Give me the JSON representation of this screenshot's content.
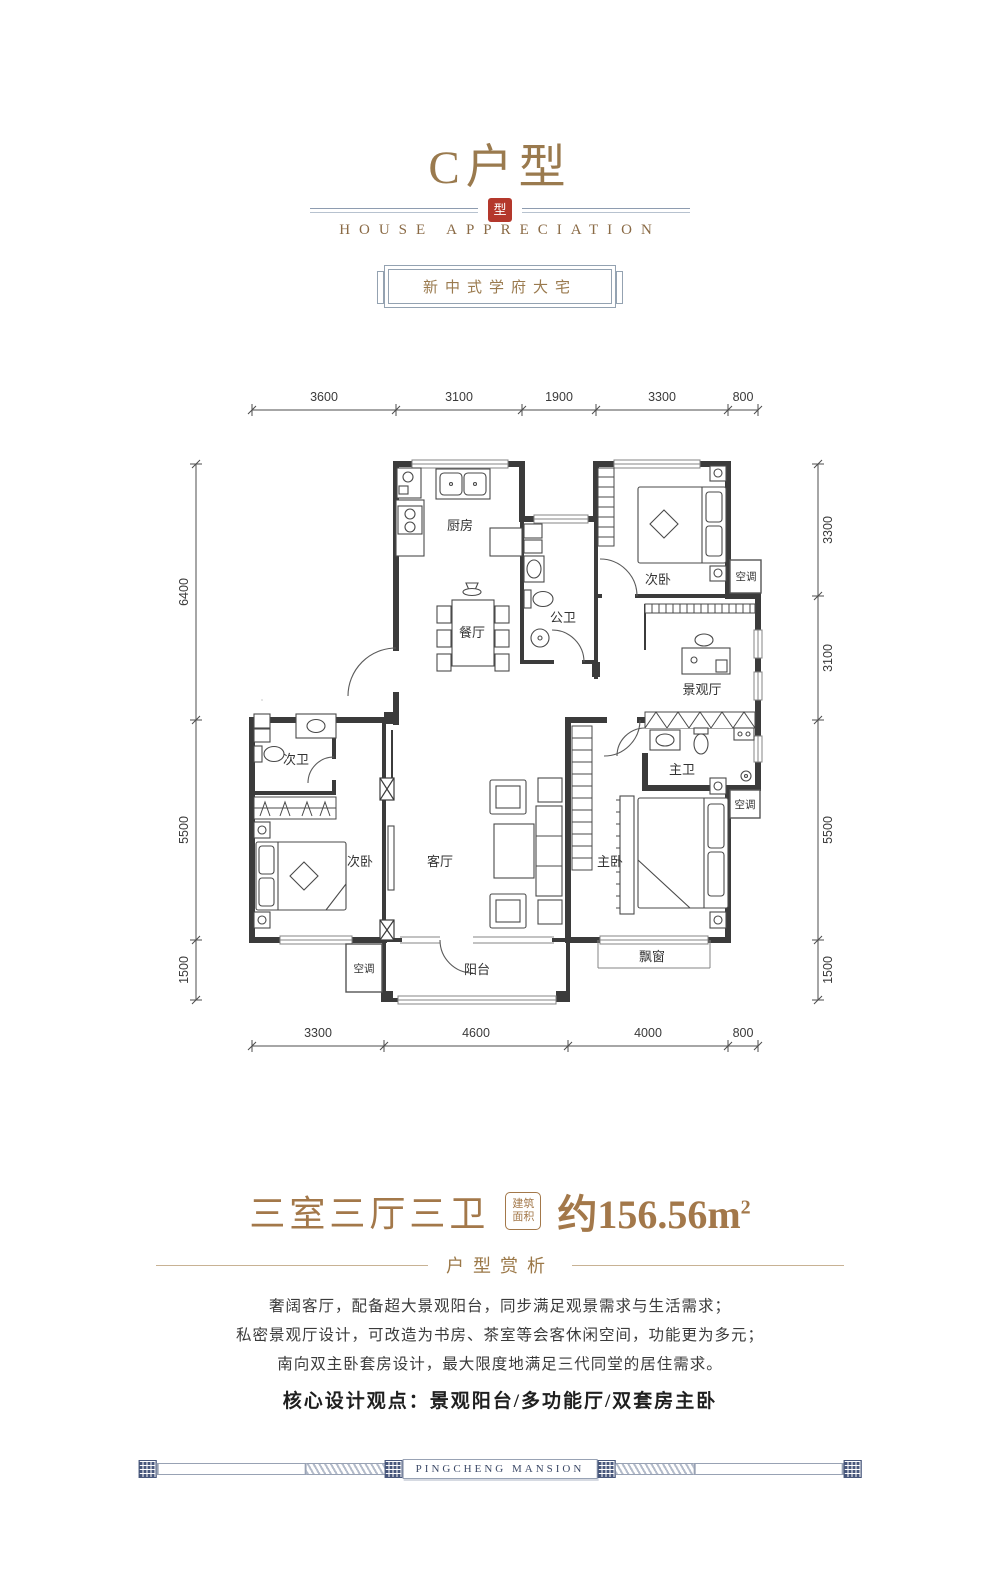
{
  "header": {
    "title": "C户型",
    "seal_glyph": "型",
    "subtitle": "HOUSE APPRECIATION",
    "badge": "新中式学府大宅"
  },
  "plan": {
    "rooms": {
      "kitchen": "厨房",
      "dining": "餐厅",
      "public_bath": "公卫",
      "bedroom2": "次卧",
      "view_hall": "景观厅",
      "master_bath": "主卫",
      "bath2": "次卫",
      "living": "客厅",
      "master": "主卧",
      "balcony": "阳台",
      "bay": "飘窗",
      "ac": "空调"
    },
    "dims": {
      "top": [
        "3600",
        "3100",
        "1900",
        "3300",
        "800"
      ],
      "bottom": [
        "3300",
        "4600",
        "4000",
        "800"
      ],
      "left": [
        "6400",
        "5500",
        "1500"
      ],
      "right": [
        "3300",
        "3100",
        "5500",
        "1500"
      ]
    }
  },
  "spec": {
    "rooms_label": "三室三厅三卫",
    "area_box_line1": "建筑",
    "area_box_line2": "面积",
    "area_value": "约156.56m",
    "area_sup": "2"
  },
  "analysis": {
    "section_title": "户型赏析",
    "lines": [
      "奢阔客厅，配备超大景观阳台，同步满足观景需求与生活需求；",
      "私密景观厅设计，可改造为书房、茶室等会客休闲空间，功能更为多元；",
      "南向双主卧套房设计，最大限度地满足三代同堂的居住需求。"
    ],
    "core": "核心设计观点：景观阳台/多功能厅/双套房主卧"
  },
  "footer": {
    "brand": "PINGCHENG MANSION"
  },
  "colors": {
    "bronze": "#9a7a4e",
    "seal_red": "#b4382c",
    "wall": "#3b3b3b",
    "frame_blue": "#93a2b1",
    "footer_navy": "#47567b"
  }
}
